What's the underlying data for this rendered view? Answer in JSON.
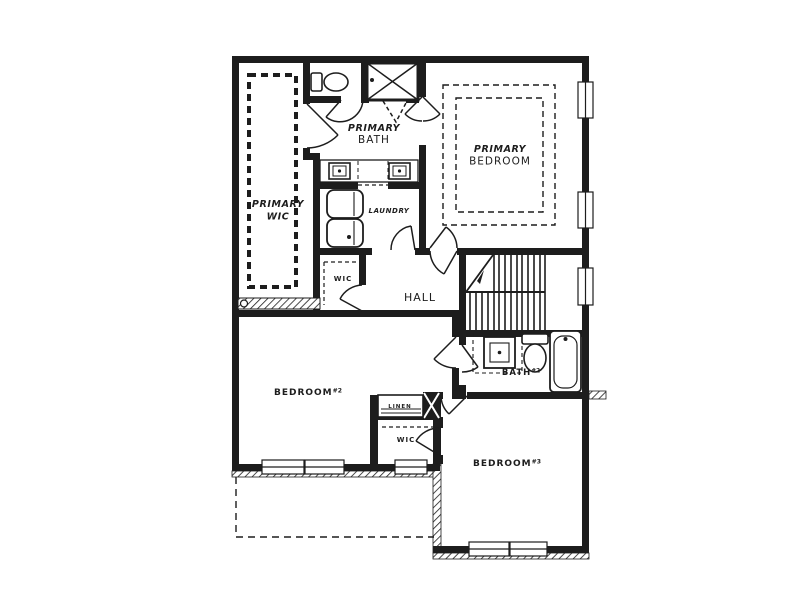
{
  "colors": {
    "background": "#ffffff",
    "line": "#1d1d1d"
  },
  "plan": {
    "type": "floor-plan",
    "rooms": [
      "PRIMARY BATH",
      "PRIMARY BEDROOM",
      "PRIMARY WIC",
      "LAUNDRY",
      "WIC",
      "HALL",
      "BEDROOM#2",
      "LINEN",
      "WIC",
      "BEDROOM#3",
      "BATH#2"
    ],
    "labels": [
      {
        "name": "label-primary-bath",
        "x": 374,
        "y": 131,
        "lh": 12,
        "lines": [
          {
            "t": "PRIMARY",
            "i": 1,
            "b": 1,
            "s": 9.5
          },
          {
            "t": "BATH",
            "i": 0,
            "b": 0,
            "s": 10.5
          }
        ]
      },
      {
        "name": "label-primary-bedroom",
        "x": 500,
        "y": 152,
        "lh": 12.5,
        "lines": [
          {
            "t": "PRIMARY",
            "i": 1,
            "b": 1,
            "s": 9.5
          },
          {
            "t": "BEDROOM",
            "i": 0,
            "b": 0,
            "s": 10.5
          }
        ]
      },
      {
        "name": "label-primary-wic",
        "x": 278,
        "y": 207,
        "lh": 12.5,
        "lines": [
          {
            "t": "PRIMARY",
            "i": 1,
            "b": 1,
            "s": 9.5
          },
          {
            "t": "WIC",
            "i": 1,
            "b": 1,
            "s": 9.5
          }
        ]
      },
      {
        "name": "label-laundry",
        "x": 389,
        "y": 213,
        "lh": 11,
        "lines": [
          {
            "t": "LAUNDRY",
            "i": 1,
            "b": 1,
            "s": 7
          }
        ]
      },
      {
        "name": "label-wic-hall",
        "x": 343,
        "y": 281,
        "lh": 11,
        "lines": [
          {
            "t": "WIC",
            "i": 0,
            "b": 1,
            "s": 7
          }
        ]
      },
      {
        "name": "label-hall",
        "x": 420,
        "y": 301,
        "lh": 11,
        "lines": [
          {
            "t": "HALL",
            "i": 0,
            "b": 0,
            "s": 11
          }
        ]
      },
      {
        "name": "label-bedroom-2",
        "x": 308,
        "y": 395,
        "lh": 11,
        "lines": [
          {
            "t": "BEDROOM#2",
            "i": 0,
            "b": 1,
            "s": 9
          }
        ]
      },
      {
        "name": "label-linen",
        "x": 400,
        "y": 408,
        "lh": 8,
        "lines": [
          {
            "t": "LINEN",
            "i": 0,
            "b": 1,
            "s": 5.5
          }
        ]
      },
      {
        "name": "label-wic-bedroom3",
        "x": 406,
        "y": 442,
        "lh": 11,
        "lines": [
          {
            "t": "WIC",
            "i": 0,
            "b": 1,
            "s": 7
          }
        ]
      },
      {
        "name": "label-bedroom-3",
        "x": 507,
        "y": 466,
        "lh": 11,
        "lines": [
          {
            "t": "BEDROOM#3",
            "i": 0,
            "b": 1,
            "s": 9
          }
        ]
      },
      {
        "name": "label-bath-2",
        "x": 521,
        "y": 375,
        "lh": 10,
        "lines": [
          {
            "t": "BATH#2",
            "i": 0,
            "b": 1,
            "s": 8.5
          }
        ]
      }
    ]
  }
}
